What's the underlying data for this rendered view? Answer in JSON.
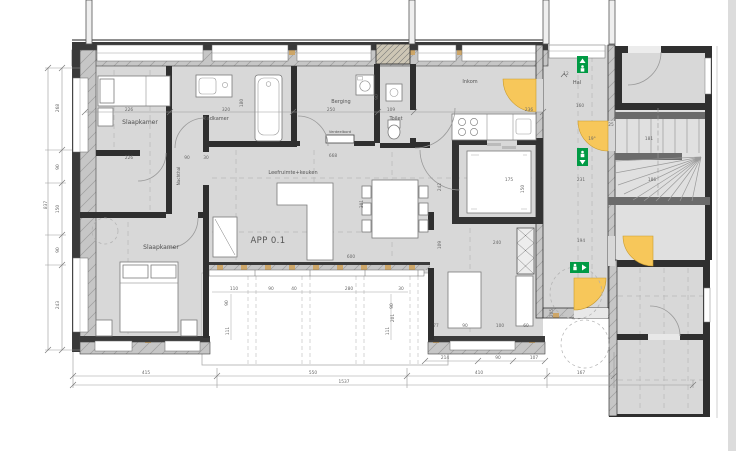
{
  "plan": {
    "apartment_id": "APP 0.1",
    "rooms": {
      "slaapkamer1": "Slaapkamer",
      "badkamer": "Badkamer",
      "berging": "Berging",
      "verdeelbord": "Verdeelbord",
      "toilet": "Toilet",
      "inkom": "Inkom",
      "hal": "Hal",
      "nachthal": "Nachthal",
      "leefruimte": "Leefruimte+keuken",
      "slaapkamer2": "Slaapkamer"
    },
    "level_marker": "12",
    "colors": {
      "floor": "#d8d8d8",
      "stair_floor": "#e0e0e0",
      "wall_dark": "#2f2f2f",
      "stud_tan": "#cda668",
      "door_yellow": "#f7c75a",
      "exit_green": "#009a44",
      "dim_text": "#666666"
    },
    "dims": [
      {
        "t": "226",
        "x": 129,
        "y": 111
      },
      {
        "t": "320",
        "x": 226,
        "y": 111
      },
      {
        "t": "250",
        "x": 331,
        "y": 111
      },
      {
        "t": "109",
        "x": 391,
        "y": 111
      },
      {
        "t": "236",
        "x": 529,
        "y": 111
      },
      {
        "t": "226",
        "x": 129,
        "y": 159
      },
      {
        "t": "90",
        "x": 187,
        "y": 159
      },
      {
        "t": "30",
        "x": 206,
        "y": 159
      },
      {
        "t": "668",
        "x": 333,
        "y": 157
      },
      {
        "t": "600",
        "x": 351,
        "y": 258
      },
      {
        "t": "240",
        "x": 497,
        "y": 244
      },
      {
        "t": "110",
        "x": 234,
        "y": 290
      },
      {
        "t": "90",
        "x": 271,
        "y": 290
      },
      {
        "t": "40",
        "x": 294,
        "y": 290
      },
      {
        "t": "280",
        "x": 349,
        "y": 290
      },
      {
        "t": "30",
        "x": 401,
        "y": 290
      },
      {
        "t": "77",
        "x": 436,
        "y": 327
      },
      {
        "t": "90",
        "x": 465,
        "y": 327
      },
      {
        "t": "100",
        "x": 500,
        "y": 327
      },
      {
        "t": "60",
        "x": 526,
        "y": 327
      },
      {
        "t": "214",
        "x": 445,
        "y": 359
      },
      {
        "t": "90",
        "x": 498,
        "y": 359
      },
      {
        "t": "107",
        "x": 534,
        "y": 359
      },
      {
        "t": "415",
        "x": 146,
        "y": 374
      },
      {
        "t": "550",
        "x": 313,
        "y": 374
      },
      {
        "t": "410",
        "x": 479,
        "y": 374
      },
      {
        "t": "167",
        "x": 581,
        "y": 374
      },
      {
        "t": "1537",
        "x": 344,
        "y": 383
      },
      {
        "t": "160",
        "x": 580,
        "y": 107
      },
      {
        "t": "231",
        "x": 581,
        "y": 181
      },
      {
        "t": "186",
        "x": 652,
        "y": 181
      },
      {
        "t": "181",
        "x": 649,
        "y": 140
      },
      {
        "t": "194",
        "x": 581,
        "y": 242
      },
      {
        "t": "175",
        "x": 509,
        "y": 181
      },
      {
        "t": "25",
        "x": 611,
        "y": 126
      },
      {
        "t": "19°",
        "x": 592,
        "y": 140
      },
      {
        "t": "12",
        "x": 566,
        "y": 75
      },
      {
        "t": "268",
        "x": 59,
        "y": 108,
        "r": 1
      },
      {
        "t": "90",
        "x": 59,
        "y": 167,
        "r": 1
      },
      {
        "t": "150",
        "x": 59,
        "y": 209,
        "r": 1
      },
      {
        "t": "90",
        "x": 59,
        "y": 250,
        "r": 1
      },
      {
        "t": "243",
        "x": 59,
        "y": 305,
        "r": 1
      },
      {
        "t": "837",
        "x": 47,
        "y": 205,
        "r": 1
      },
      {
        "t": "180",
        "x": 243,
        "y": 103,
        "r": 1
      },
      {
        "t": "90",
        "x": 378,
        "y": 97,
        "r": 1
      },
      {
        "t": "301",
        "x": 363,
        "y": 204,
        "r": 1
      },
      {
        "t": "242",
        "x": 441,
        "y": 187,
        "r": 1
      },
      {
        "t": "109",
        "x": 441,
        "y": 245,
        "r": 1
      },
      {
        "t": "90",
        "x": 228,
        "y": 303,
        "r": 1
      },
      {
        "t": "111",
        "x": 229,
        "y": 331,
        "r": 1
      },
      {
        "t": "90",
        "x": 393,
        "y": 306,
        "r": 1
      },
      {
        "t": "201",
        "x": 394,
        "y": 318,
        "r": 1
      },
      {
        "t": "111",
        "x": 389,
        "y": 331,
        "r": 1
      },
      {
        "t": "150",
        "x": 524,
        "y": 189,
        "r": 1
      },
      {
        "t": "205",
        "x": 553,
        "y": 313,
        "r": 1
      }
    ]
  }
}
